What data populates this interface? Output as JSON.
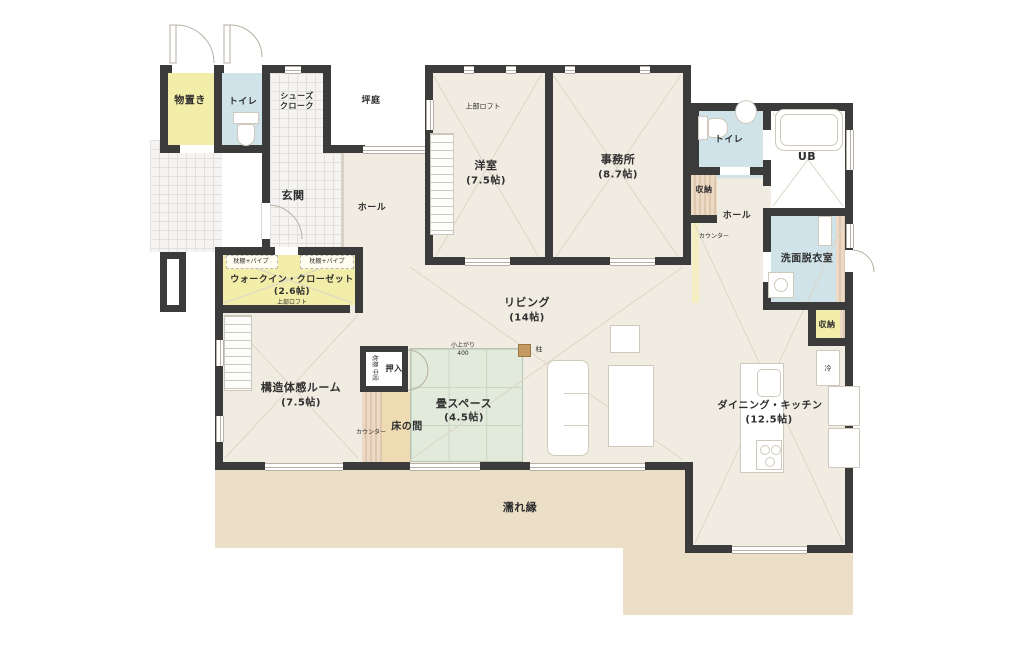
{
  "title": "住宅 平面間取り図",
  "colors": {
    "wall": "#3b3b3b",
    "floor": "#f1ece2",
    "deck": "#ebdfc7",
    "accent_yellow": "#f2eda8",
    "accent_blue": "#cfe3e9",
    "tatami": "#e2eadb",
    "tokonoma": "#efdbb2",
    "line": "#dcd5c8",
    "door": "#b6afa3"
  },
  "rooms": {
    "storage": {
      "name": "物置き"
    },
    "toilet1": {
      "name": "トイレ"
    },
    "shoes_closet": {
      "name": "シューズ\nクローク"
    },
    "tsuboniwa": {
      "name": "坪庭"
    },
    "genkan": {
      "name": "玄関"
    },
    "hall_left": {
      "name": "ホール"
    },
    "yoshitsu": {
      "name": "洋室",
      "size": "(7.5帖)",
      "loft": "上部ロフト"
    },
    "jimusho": {
      "name": "事務所",
      "size": "(8.7帖)"
    },
    "toilet2": {
      "name": "トイレ"
    },
    "ub": {
      "name": "UB"
    },
    "shuno_hall": {
      "name": "収納"
    },
    "hall_right": {
      "name": "ホール"
    },
    "counter_hall": {
      "name": "カウンター"
    },
    "senmen": {
      "name": "洗面脱衣室"
    },
    "shuno_dk": {
      "name": "収納"
    },
    "fridge": {
      "name": "冷"
    },
    "wic": {
      "name": "ウォークイン・クローゼット",
      "size": "(2.6帖)",
      "loft": "上部ロフト",
      "shelf1": "枕棚+パイプ",
      "shelf2": "枕棚+パイプ"
    },
    "kozo": {
      "name": "構造体感ルーム",
      "size": "(7.5帖)"
    },
    "oshiire": {
      "name": "押入",
      "inner": "枕棚 中段"
    },
    "counter_mid": {
      "name": "カウンター"
    },
    "tokonoma": {
      "name": "床の間"
    },
    "tatami": {
      "name": "畳スペース",
      "size": "(4.5帖)",
      "step": "小上がり\n400"
    },
    "pillar": {
      "name": "柱"
    },
    "living": {
      "name": "リビング",
      "size": "(14帖)"
    },
    "dk": {
      "name": "ダイニング・キッチン",
      "size": "(12.5帖)"
    },
    "nureen": {
      "name": "濡れ縁"
    }
  }
}
